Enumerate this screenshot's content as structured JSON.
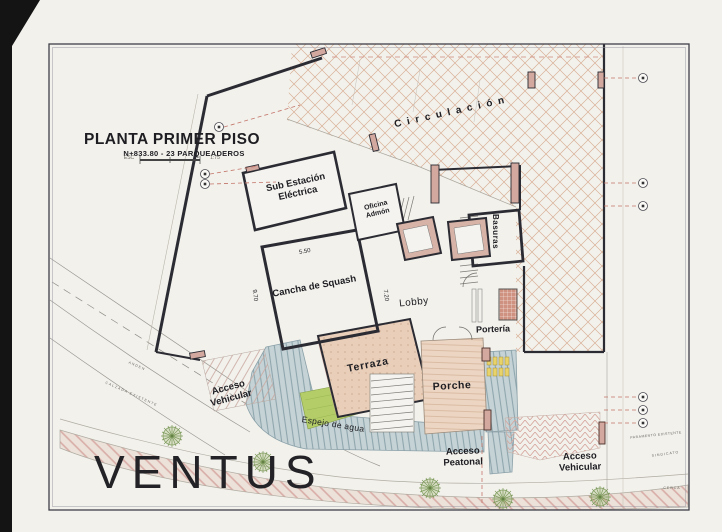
{
  "project_name": "VENTUS",
  "title_block": {
    "title": "PLANTA PRIMER PISO",
    "subtitle": "N+833.80 - 23 PARQUEADEROS",
    "scale_prefix": "ESC",
    "scale_value": "1:75"
  },
  "rooms": {
    "circulacion": "C i r c u l a c i ó n",
    "sub_estacion": "Sub Estación\nEléctrica",
    "oficina": "Oficina\nAdmón",
    "squash": "Cancha de Squash",
    "lobby": "Lobby",
    "basuras": "Basuras",
    "porteria": "Portería",
    "terraza": "Terraza",
    "porche": "Porche",
    "espejo_agua": "Espejo de agua",
    "acceso_vehicular_izq": "Acceso\nVehicular",
    "acceso_peatonal": "Acceso\nPeatonal",
    "acceso_vehicular_der": "Acceso\nVehicular"
  },
  "dimensions": {
    "squash_width": "5.50",
    "squash_depth": "9.70",
    "lobby_depth": "7.20"
  },
  "site_labels": {
    "street_upper": "ANDEN",
    "street_lower": "CALZADA EXISTENTE",
    "margin_upper": "PARAMENTO EXISTENTE",
    "margin_mid": "SINDICATO",
    "margin_lower": "CERCA"
  },
  "colors": {
    "paper": "#f2f1ec",
    "ink": "#2b2b33",
    "wall_fill": "#d2a89f",
    "lattice": "#d8b097",
    "water": "#c6d3d6",
    "water_stripe": "#8ea6ad",
    "planter": "#b4cd68",
    "terrace": "#e9cfba",
    "porch": "#ecd6c3",
    "walk_stripe": "#d8aca6",
    "leader_red": "#c4766a",
    "tree": "#7d9a5b"
  }
}
